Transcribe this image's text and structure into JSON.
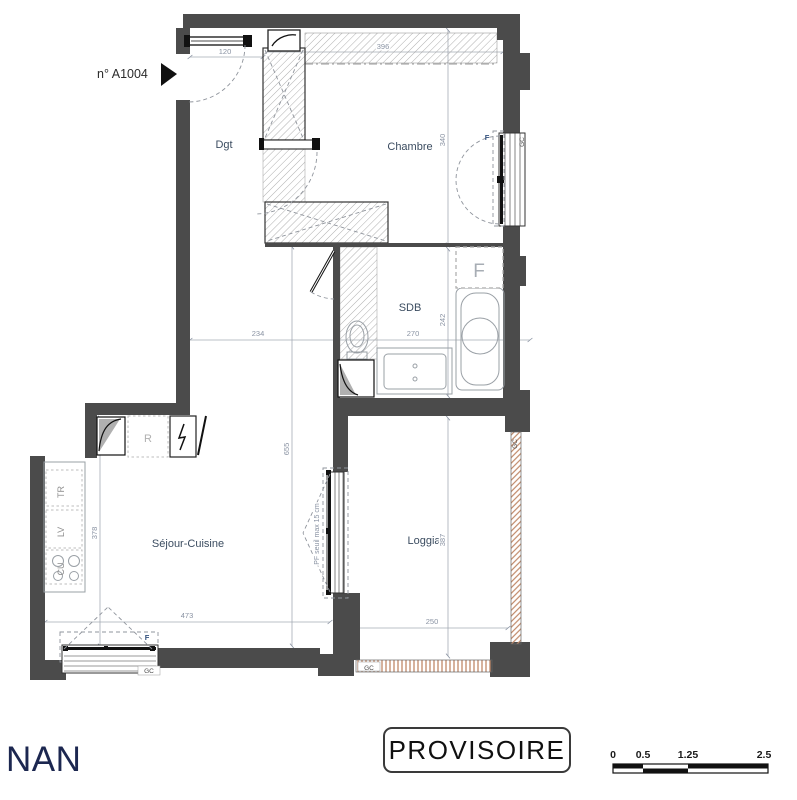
{
  "plan": {
    "unit_label": "n° A1004",
    "rooms": {
      "dgt": "Dgt",
      "chambre": "Chambre",
      "sdb": "SDB",
      "sejour_cuisine": "Séjour-Cuisine",
      "loggia": "Loggia"
    },
    "dimensions_cm": {
      "entry_width": "120",
      "chambre_top": "396",
      "dgt_width": "234",
      "sdb_width": "270",
      "chambre_height": "340",
      "sdb_height": "242",
      "dgt_sejour_height": "655",
      "kitchen_height": "378",
      "sejour_width": "473",
      "loggia_width": "250",
      "loggia_height": "387"
    },
    "annotations": {
      "window_f_chambre": "F",
      "gc_chambre": "GC",
      "window_f_sejour": "F",
      "gc_sejour": "GC",
      "gc_loggia_bottom": "GC",
      "gc_loggia_right": "GC",
      "fridge_r": "R",
      "kitchen_tr": "TR",
      "kitchen_lv": "LV",
      "kitchen_cu": "CU",
      "pf_note": "PF  seuil max 15 cm",
      "sdb_f": "F"
    }
  },
  "stamp_text": "PROVISOIRE",
  "logo_text": "NAN",
  "scale_bar": {
    "t0": "0",
    "t1": "0.5",
    "t2": "1.25",
    "t3": "2.5"
  },
  "colors": {
    "wall": "#4b4b4b",
    "gc_hatch": "#c08868",
    "logo_navy": "#1c2750"
  }
}
